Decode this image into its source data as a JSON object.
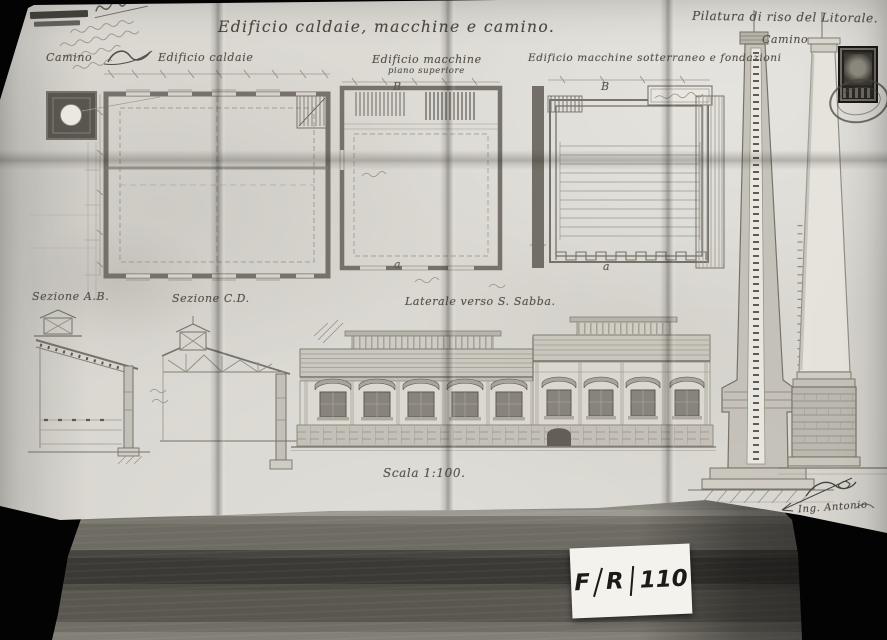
{
  "photo": {
    "background": "#000000",
    "card": {
      "parts": [
        "F",
        "R",
        "110"
      ]
    }
  },
  "sheet": {
    "paper_color": "#dcdad3",
    "ink_color": "#57534a",
    "title": "Edificio caldaie, macchine e camino.",
    "top_right_title": "Pilatura di riso del Litorale.",
    "plan_labels": {
      "camino": "Camino",
      "edificio_caldaie": "Edificio caldaie",
      "edificio_macchine": "Edificio macchine",
      "piano_superiore": "piano superiore",
      "edificio_macchine_sotterraneo": "Edificio macchine sotterraneo e fondazioni",
      "camino_right": "Camino"
    },
    "view_labels": {
      "sezione_ab": "Sezione A.B.",
      "sezione_cd": "Sezione C.D.",
      "facciata": "Laterale verso S. Sabba.",
      "scala": "Scala 1:100."
    },
    "section_markers": {
      "b_left": "B",
      "b_right": "B",
      "a_left": "a",
      "a_right": "a"
    },
    "signature": "Ing. Antonio"
  }
}
